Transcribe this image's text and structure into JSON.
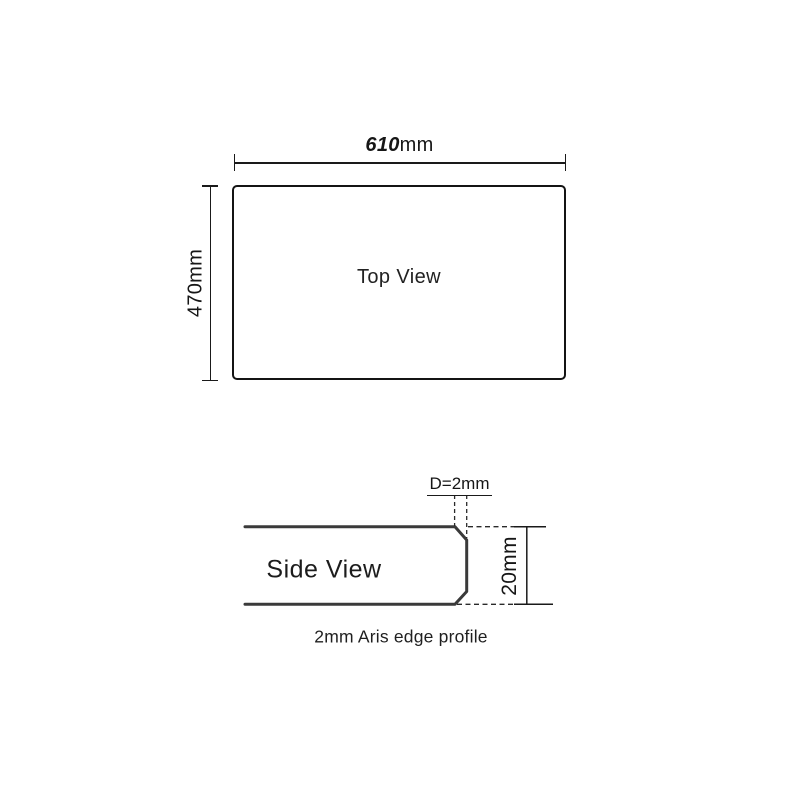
{
  "drawing": {
    "top_view": {
      "label": "Top View",
      "width_dim": {
        "value": "610",
        "unit": "mm"
      },
      "height_dim": "470mm"
    },
    "side_view": {
      "label": "Side View",
      "edge_diameter_dim": "D=2mm",
      "thickness_dim": "20mm",
      "caption": "2mm Aris edge profile"
    },
    "colors": {
      "ink": "#1a1a1a",
      "profile_stroke": "#3a3a3a",
      "background": "#ffffff"
    }
  }
}
